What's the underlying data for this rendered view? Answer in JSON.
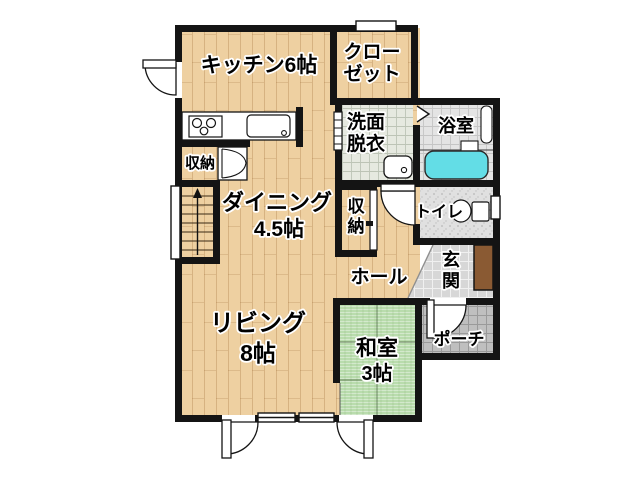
{
  "plan_title": "1F floor plan",
  "rooms": {
    "kitchen": {
      "label": "キッチン6帖"
    },
    "closet": {
      "line1": "クロー",
      "line2": "ゼット"
    },
    "washroom": {
      "line1": "洗面",
      "line2": "脱衣"
    },
    "bathroom": {
      "label": "浴室"
    },
    "storage_kitchen": {
      "label": "収納"
    },
    "dining": {
      "line1": "ダイニング",
      "line2": "4.5帖"
    },
    "storage_hall": {
      "char1": "収",
      "char2": "納"
    },
    "toilet": {
      "label": "トイレ"
    },
    "hall": {
      "label": "ホール"
    },
    "entrance": {
      "char1": "玄",
      "char2": "関"
    },
    "living": {
      "line1": "リビング",
      "line2": "8帖"
    },
    "japanese_room": {
      "line1": "和室",
      "line2": "3帖"
    },
    "porch": {
      "label": "ポーチ"
    }
  },
  "colors": {
    "wall": "#141414",
    "wood_floor": "#eed0a1",
    "tatami": "#b9dcad",
    "bathtub": "#63dde6",
    "shoe_cabinet": "#8a5a33",
    "washroom_tile": "#e6e9e0",
    "bath_tile": "#e4e4e4",
    "toilet_floor": "#e0e0e0",
    "entrance_tile": "#d7d7d7",
    "porch_tile": "#bfbfbf"
  }
}
